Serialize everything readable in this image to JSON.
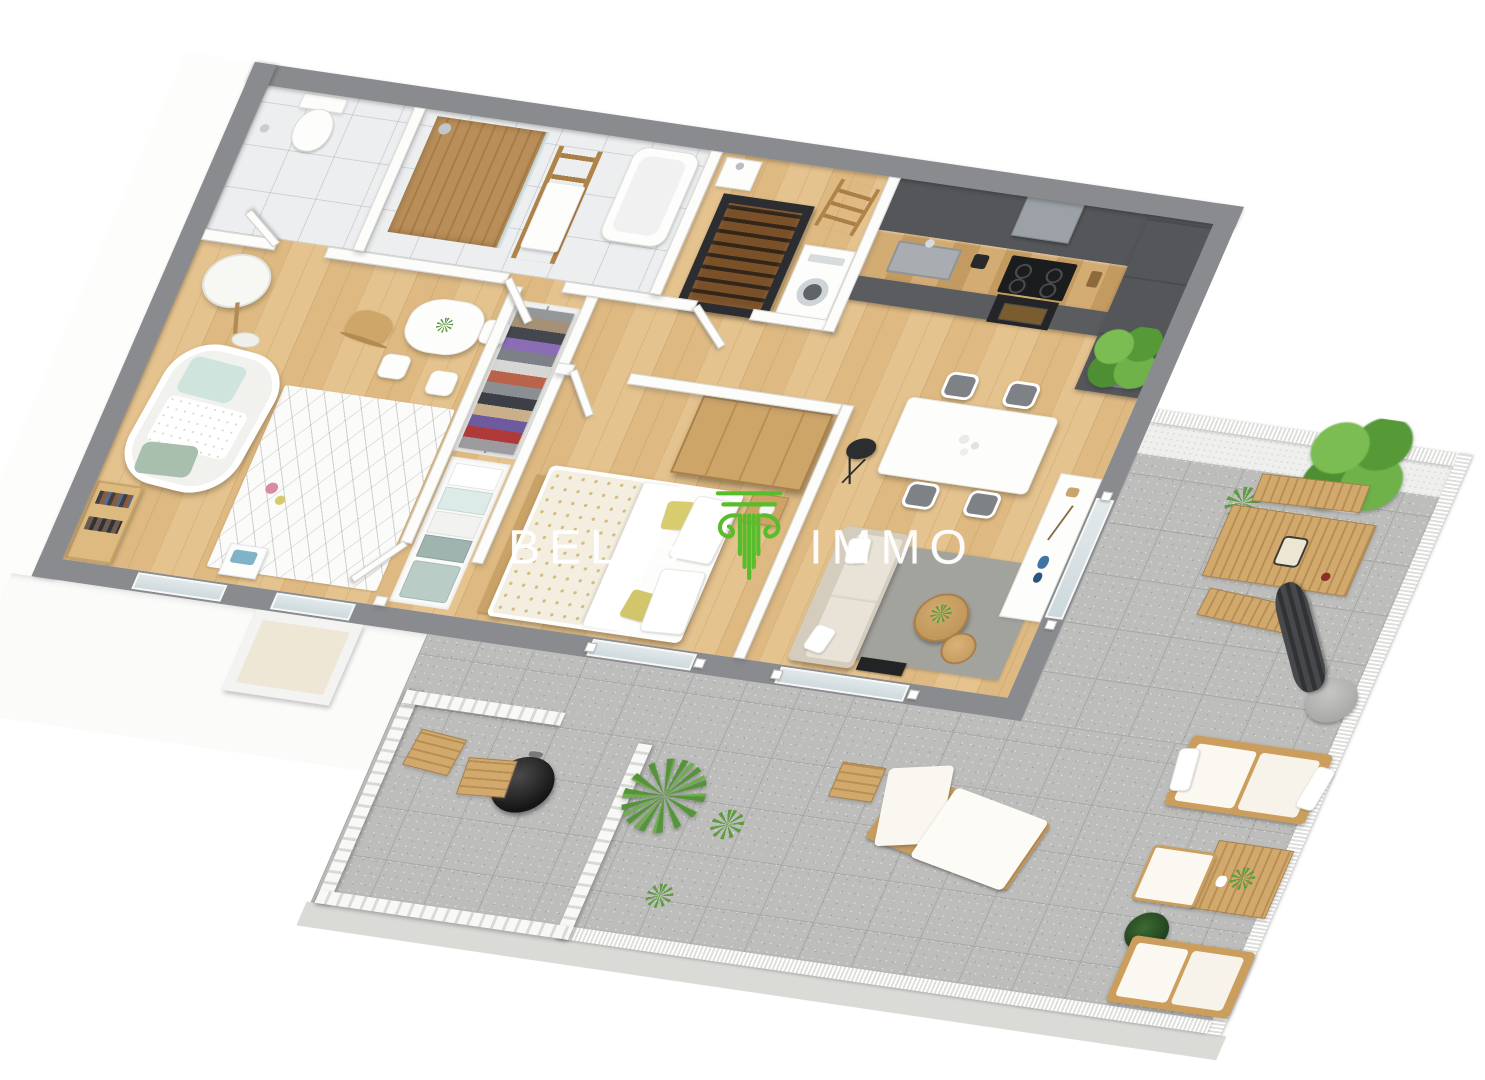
{
  "brand": {
    "name_left": "BELIS",
    "name_right": "IMMO",
    "logo_icon": "greek-column-icon",
    "wordmark_color": "#ffffff",
    "logo_green": "#58bd2a"
  },
  "palette": {
    "background": "#ffffff",
    "outer_wall_gray": "#8a8b8f",
    "partition_white": "#fcfcfb",
    "wood_floor": "#e3bf87",
    "bathroom_tile": "#eceeef",
    "terrace_tile": "#bdbdbb",
    "kitchen_cabinet_gray": "#54565a",
    "worktop_wood": "#cfa870",
    "sofa_beige": "#e8e2d6",
    "accent_yellow": "#d8cd6e",
    "mint": "#cfe4dd",
    "vase_blue": "#3f74a3"
  },
  "scene": {
    "view": "3d-isometric-apartment-floor-plan",
    "rooms": [
      {
        "name": "wc",
        "items": [
          "toilet",
          "toilet-paper-holder"
        ]
      },
      {
        "name": "bathroom",
        "items": [
          "walk-in-shower",
          "wood-shower-wall",
          "glass-screen",
          "towel-ladder",
          "bathtub"
        ]
      },
      {
        "name": "laundry",
        "items": [
          "corner-sink",
          "wine-cabinet",
          "washing-machine",
          "ladder-shelf"
        ]
      },
      {
        "name": "kitchen",
        "items": [
          "wall-cabinets",
          "extractor-hood",
          "sink",
          "coffee-maker",
          "induction-hob",
          "oven",
          "tall-cabinets",
          "potted-plant"
        ]
      },
      {
        "name": "dining-area",
        "items": [
          "white-dining-table",
          "four-gray-chairs",
          "black-floor-lamp"
        ]
      },
      {
        "name": "living-room",
        "items": [
          "beige-sofa",
          "gray-rug",
          "round-coffee-tables",
          "media-unit",
          "white-sideboard",
          "blue-vases"
        ]
      },
      {
        "name": "bedroom",
        "items": [
          "double-bed",
          "patterned-duvet",
          "yellow-cushions",
          "wood-wardrobe",
          "nightstand",
          "foot-bench"
        ]
      },
      {
        "name": "walk-in-closet",
        "items": [
          "clothes-rail",
          "folded-linen-shelves"
        ]
      },
      {
        "name": "nursery",
        "items": [
          "crib",
          "floor-lamp",
          "bookshelf",
          "patterned-rug",
          "kids-table",
          "kids-chairs",
          "rocking-horse",
          "toy-bin"
        ]
      },
      {
        "name": "balcony",
        "items": [
          "white-railing"
        ]
      },
      {
        "name": "terrace",
        "items": [
          "slat-fence",
          "barbecue-grill",
          "wood-stools",
          "palm-plant",
          "grass-plants",
          "sun-lounger",
          "side-table",
          "outdoor-dining-table",
          "wood-benches",
          "lantern",
          "closed-patio-umbrella",
          "potted-tree",
          "outdoor-sofas",
          "outdoor-coffee-table",
          "ottoman",
          "dark-plant",
          "mesh-railing"
        ]
      }
    ]
  }
}
